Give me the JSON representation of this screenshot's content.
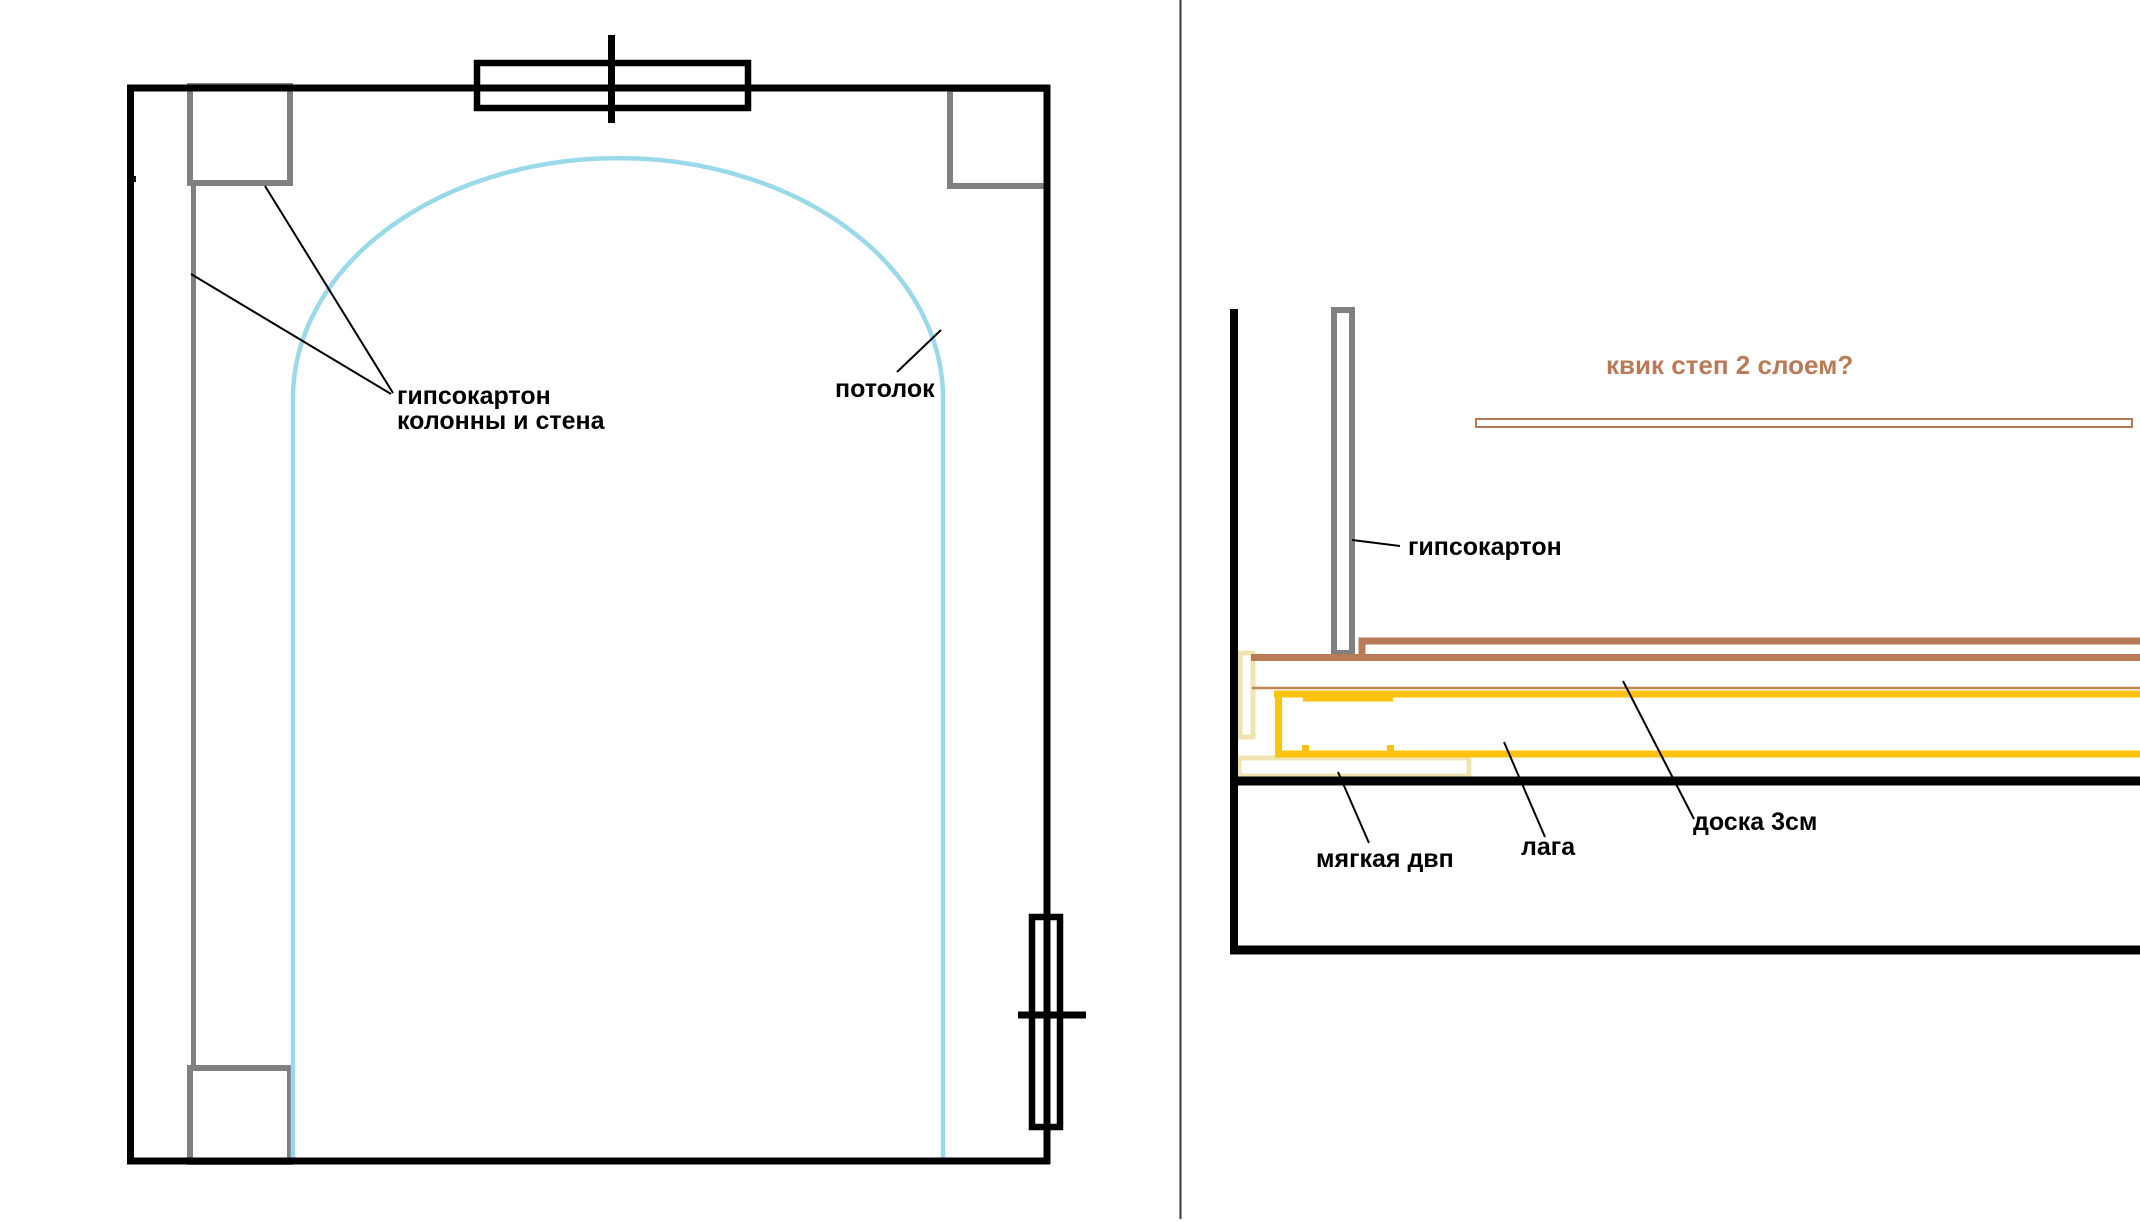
{
  "canvas": {
    "width_px": 2140,
    "height_px": 1222,
    "background": "#ffffff"
  },
  "colors": {
    "structure_black": "#000000",
    "column_gray": "#808080",
    "arch_blue": "#99d9ea",
    "quickstep_brown": "#b97a57",
    "underlay_tan": "#c08552",
    "board_gold": "#ffc20e",
    "fiberboard_cream": "#efe4b0",
    "title_orange": "#b97a57",
    "divider_gray": "#383838"
  },
  "left_diagram": {
    "labels": {
      "drywall_line1": "гипсокартон",
      "drywall_line2": "колонны и стена",
      "ceiling": "потолок"
    }
  },
  "right_diagram": {
    "labels": {
      "quickstep_question": "квик степ 2 слоем?",
      "drywall": "гипсокартон",
      "soft_fiberboard": "мягкая двп",
      "joist": "лага",
      "board_3cm": "доска 3см"
    }
  }
}
